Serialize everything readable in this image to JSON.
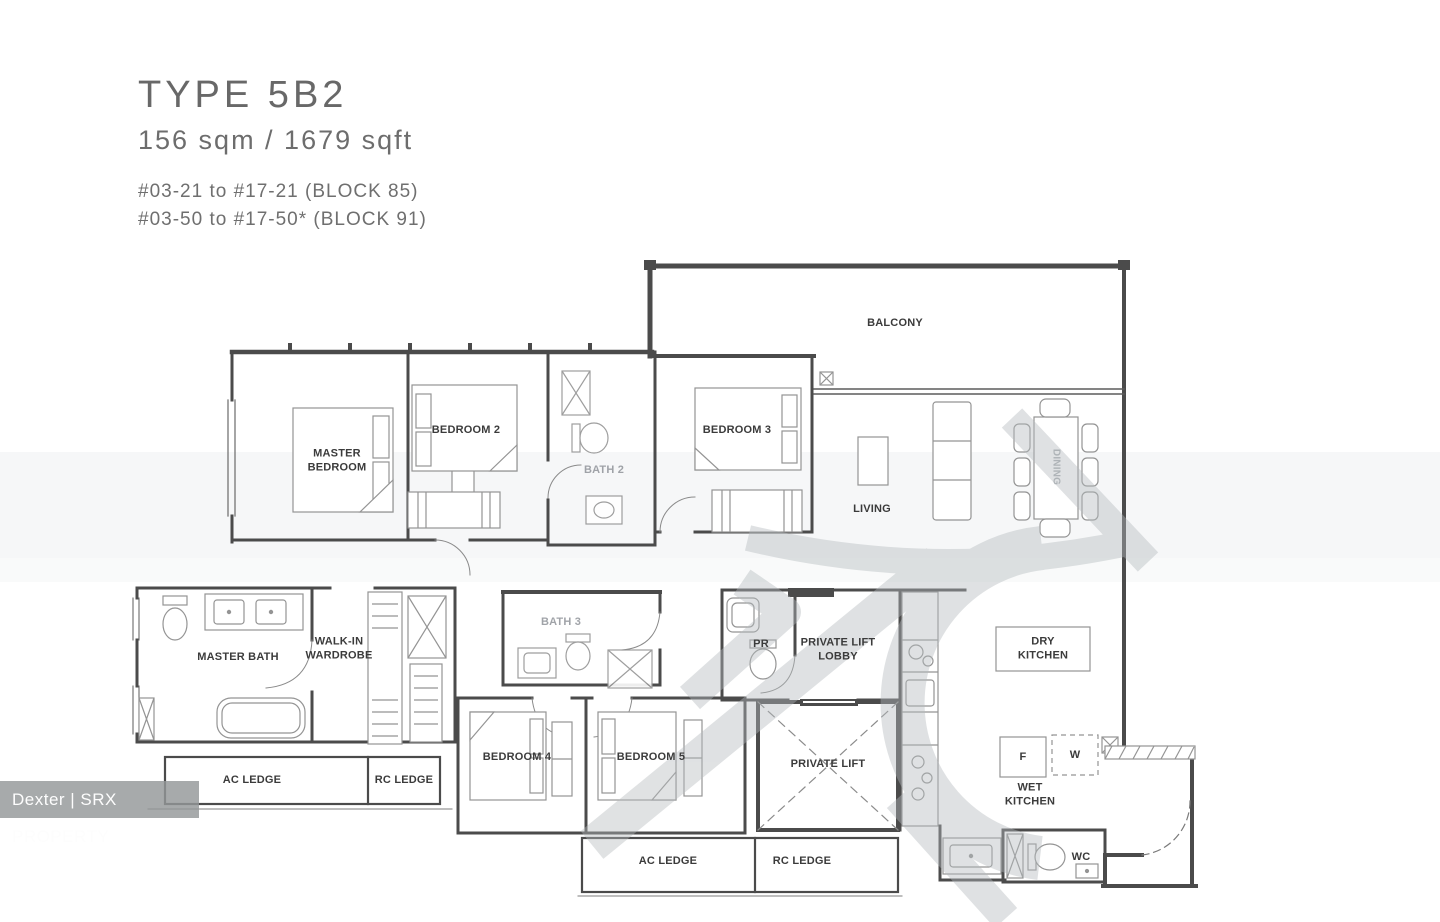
{
  "header": {
    "type_label": "TYPE 5B2",
    "area_label": "156 sqm / 1679 sqft",
    "unit_ranges": [
      "#03-21 to #17-21 (BLOCK 85)",
      "#03-50 to #17-50* (BLOCK 91)"
    ]
  },
  "rooms": {
    "balcony": "BALCONY",
    "master_bedroom": "MASTER BEDROOM",
    "bedroom_2": "BEDROOM 2",
    "bath_2": "BATH 2",
    "bedroom_3": "BEDROOM 3",
    "living": "LIVING",
    "dining": "DINING",
    "master_bath": "MASTER BATH",
    "walk_in_wardrobe": "WALK-IN WARDROBE",
    "bath_3": "BATH 3",
    "bedroom_4": "BEDROOM 4",
    "bedroom_5": "BEDROOM 5",
    "pr": "PR",
    "private_lift_lobby": "PRIVATE LIFT LOBBY",
    "private_lift": "PRIVATE LIFT",
    "dry_kitchen": "DRY KITCHEN",
    "wet_kitchen": "WET KITCHEN",
    "wc": "WC"
  },
  "appliances": {
    "fridge": "F",
    "washer": "W"
  },
  "ledges": {
    "ac_ledge": "AC LEDGE",
    "rc_ledge": "RC LEDGE"
  },
  "watermark": {
    "credit": "Dexter | SRX PROPERTY"
  },
  "colors": {
    "wall": "#4b4b4b",
    "furniture": "#949494",
    "label": "#3b3b3b",
    "title_gray": "#6d6d6d",
    "watermark_gray": "#b4babd",
    "credit_bg": "#949799"
  }
}
